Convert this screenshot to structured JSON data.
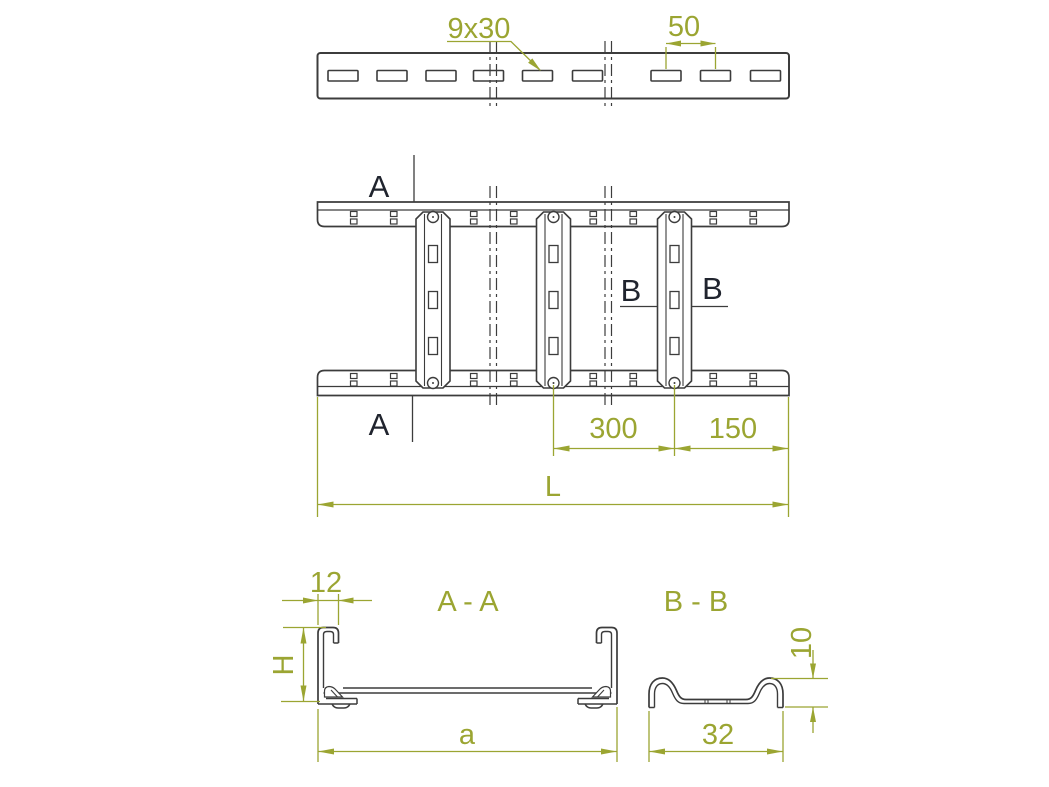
{
  "drawing": {
    "colors": {
      "dimension": "#9BA532",
      "outline": "#3C3C3C",
      "label": "#20242E",
      "background": "#FFFFFF"
    },
    "top_view": {
      "hole_size_label": "9x30",
      "hole_pitch": "50"
    },
    "plan_view": {
      "section_a_label": "A",
      "section_b_label": "B",
      "rung_spacing": "300",
      "end_spacing": "150",
      "total_length": "L"
    },
    "section_aa": {
      "title": "A - A",
      "flange_width": "12",
      "height_label": "H",
      "width_label": "a"
    },
    "section_bb": {
      "title": "B - B",
      "rung_height": "10",
      "rung_width": "32"
    }
  }
}
